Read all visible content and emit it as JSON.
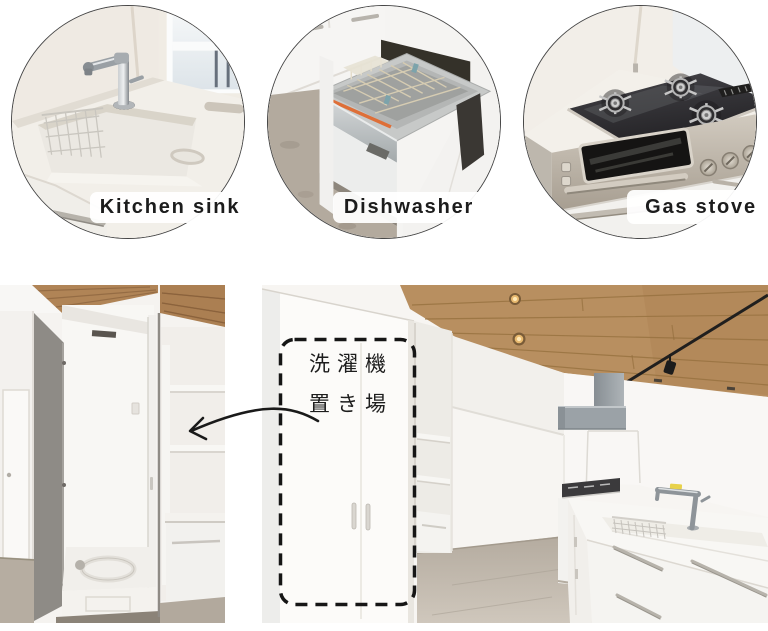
{
  "collage": {
    "background_color": "#ffffff",
    "features": [
      {
        "id": "kitchen-sink",
        "label": "Kitchen sink"
      },
      {
        "id": "dishwasher",
        "label": "Dishwasher"
      },
      {
        "id": "gas-stove",
        "label": "Gas stove"
      }
    ],
    "bottom": {
      "annotation": {
        "line1": "洗濯機",
        "line2": "置き場"
      }
    },
    "colors": {
      "circle_border": "#474747",
      "label_text": "#1c1c1c",
      "label_chip_background": "#ffffff",
      "annotation_ink": "#171717",
      "wood_ceiling": "#b88f60",
      "floor": "#beb6ab",
      "cabinet_white": "#f8f6f3",
      "stainless_steel": "#c0b9ae",
      "hood_gray": "#9ba2a7"
    }
  }
}
